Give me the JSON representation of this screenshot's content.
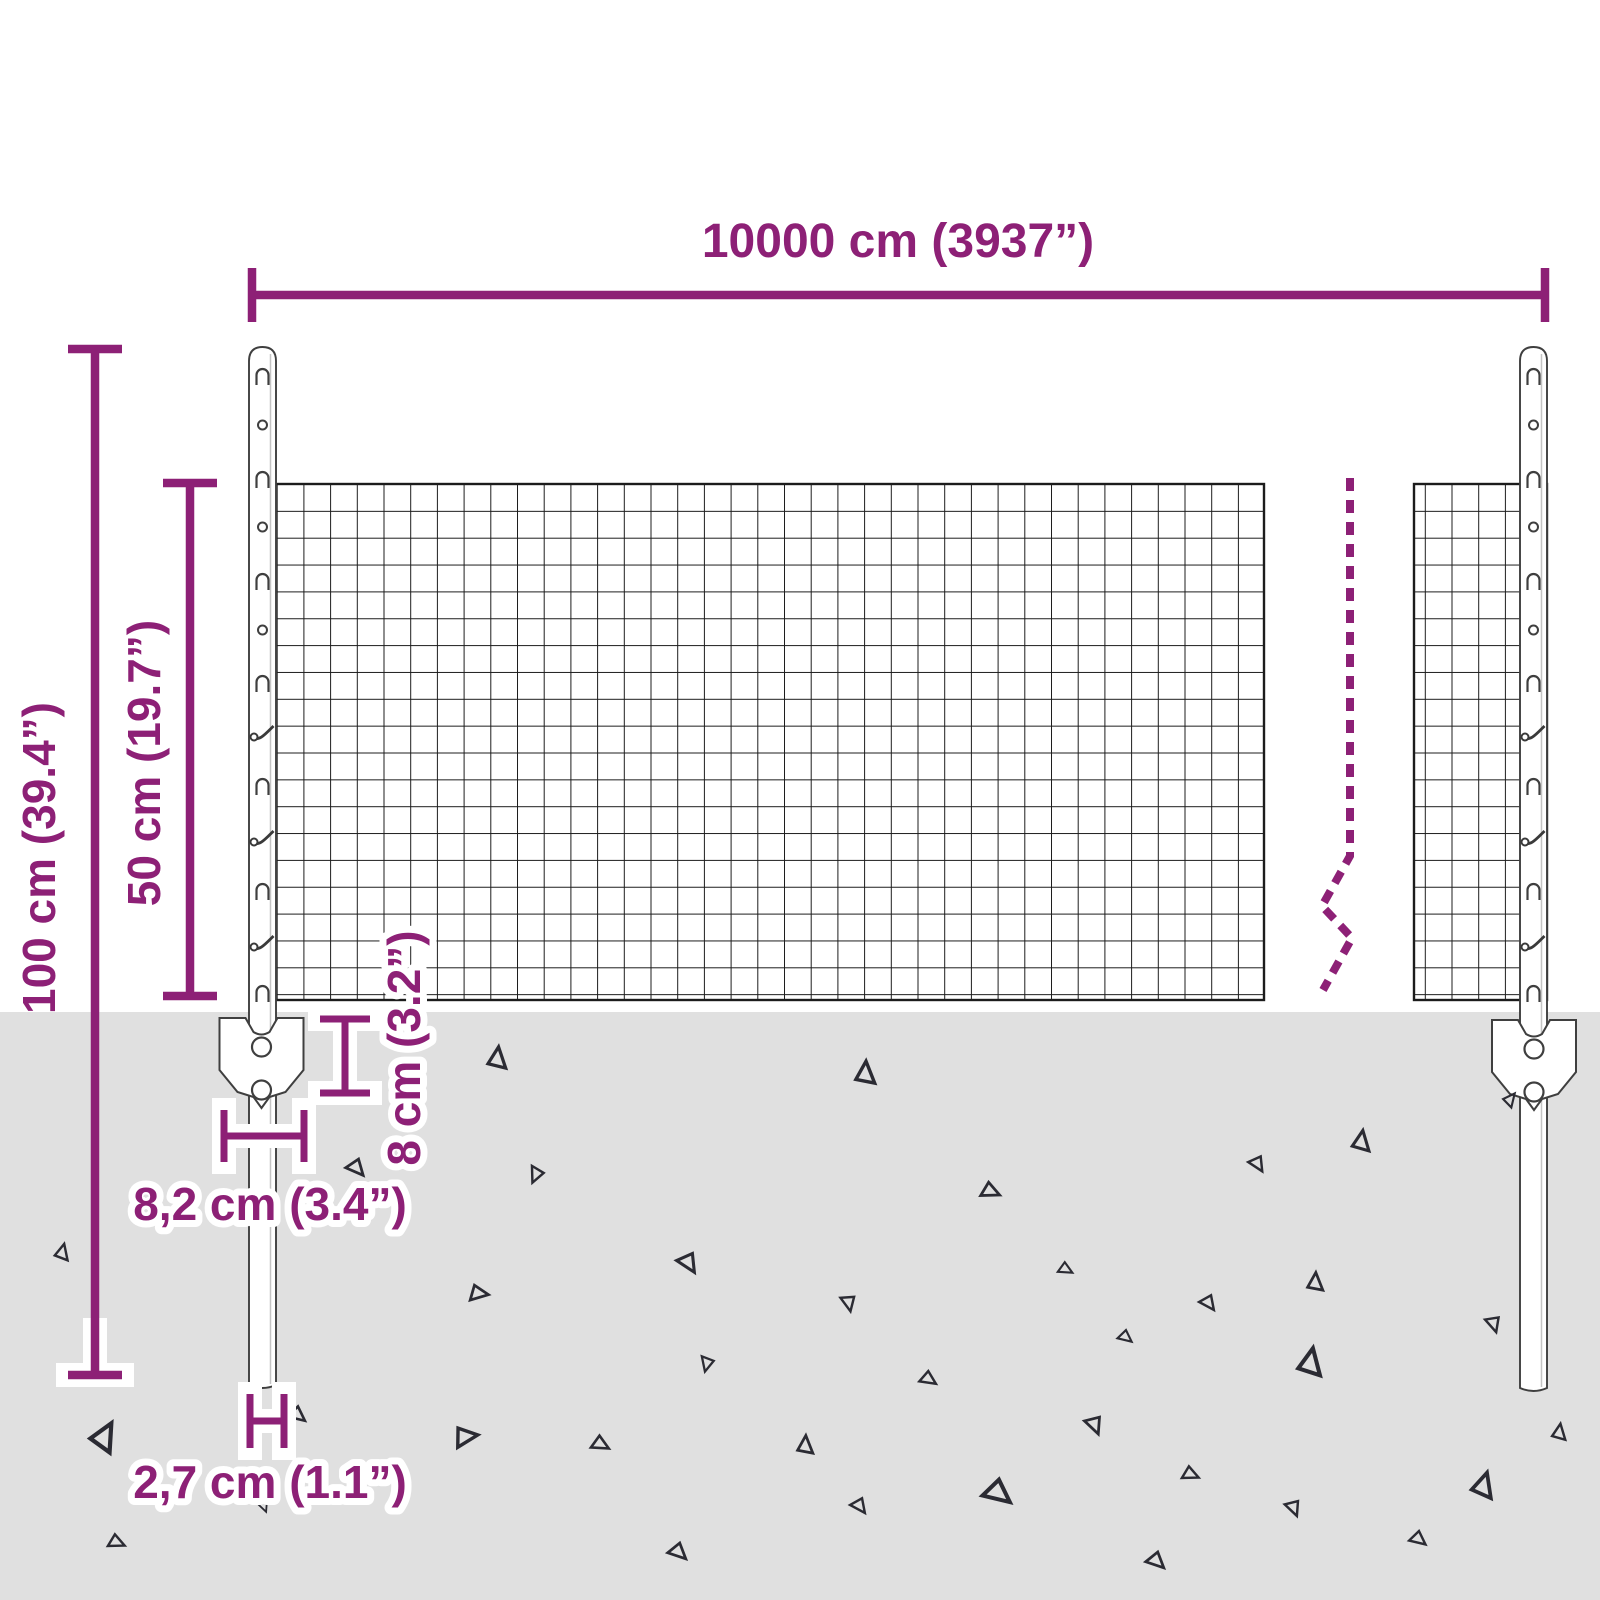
{
  "diagram": {
    "type": "product-dimension-diagram",
    "subject": "wire mesh fence set with steel posts and ground anchors",
    "labels": {
      "width": "10000 cm (3937”)",
      "total_height": "100 cm (39.4”)",
      "mesh_height": "50 cm (19.7”)",
      "anchor_depth": "8 cm (3.2”)",
      "anchor_width": "8,2 cm (3.4”)",
      "post_width": "2,7 cm (1.1”)"
    },
    "colors": {
      "accent": "#8d2076",
      "ground": "#e0e0e0",
      "mesh_line": "#1c1c1c",
      "outline": "#3f3f3f",
      "background": "#ffffff"
    }
  },
  "decor": {
    "posts": [
      {
        "side": "left",
        "cx": 262.5,
        "top": 347,
        "bottom": 1385
      },
      {
        "side": "right",
        "cx": 1533.5,
        "top": 347,
        "bottom": 1388
      }
    ],
    "post_features": [
      {
        "y": 375,
        "t": "hook"
      },
      {
        "y": 425,
        "t": "hole"
      },
      {
        "y": 478,
        "t": "hook"
      },
      {
        "y": 527,
        "t": "hole"
      },
      {
        "y": 580,
        "t": "hook"
      },
      {
        "y": 630,
        "t": "hole"
      },
      {
        "y": 682,
        "t": "hook"
      },
      {
        "y": 731,
        "t": "tie"
      },
      {
        "y": 785,
        "t": "hook"
      },
      {
        "y": 836,
        "t": "tie"
      },
      {
        "y": 890,
        "t": "hook"
      },
      {
        "y": 941,
        "t": "tie"
      },
      {
        "y": 992,
        "t": "hook"
      }
    ],
    "triangles": [
      [
        497,
        1058,
        20,
        8
      ],
      [
        536,
        1175,
        15,
        205
      ],
      [
        357,
        1168,
        17,
        140
      ],
      [
        62,
        1252,
        15,
        15
      ],
      [
        689,
        1263,
        19,
        150
      ],
      [
        479,
        1293,
        17,
        100
      ],
      [
        707,
        1364,
        14,
        195
      ],
      [
        104,
        1436,
        26,
        30
      ],
      [
        298,
        1415,
        16,
        130
      ],
      [
        466,
        1436,
        21,
        85
      ],
      [
        601,
        1444,
        16,
        120
      ],
      [
        264,
        1506,
        11,
        160
      ],
      [
        117,
        1542,
        15,
        115
      ],
      [
        679,
        1552,
        17,
        135
      ],
      [
        865,
        1073,
        21,
        5
      ],
      [
        1361,
        1141,
        19,
        10
      ],
      [
        1258,
        1164,
        15,
        150
      ],
      [
        991,
        1191,
        17,
        115
      ],
      [
        1066,
        1269,
        13,
        120
      ],
      [
        1315,
        1282,
        17,
        5
      ],
      [
        1209,
        1303,
        15,
        145
      ],
      [
        849,
        1303,
        15,
        170
      ],
      [
        1126,
        1337,
        13,
        130
      ],
      [
        1494,
        1324,
        15,
        165
      ],
      [
        1310,
        1362,
        25,
        12
      ],
      [
        929,
        1379,
        15,
        125
      ],
      [
        1095,
        1425,
        17,
        160
      ],
      [
        805,
        1445,
        17,
        5
      ],
      [
        1559,
        1432,
        15,
        10
      ],
      [
        1191,
        1474,
        15,
        115
      ],
      [
        999,
        1493,
        25,
        130
      ],
      [
        860,
        1506,
        15,
        145
      ],
      [
        1294,
        1508,
        15,
        160
      ],
      [
        1483,
        1485,
        23,
        18
      ],
      [
        1419,
        1539,
        15,
        130
      ],
      [
        1157,
        1561,
        17,
        135
      ],
      [
        1510,
        1099,
        13,
        40
      ]
    ]
  }
}
